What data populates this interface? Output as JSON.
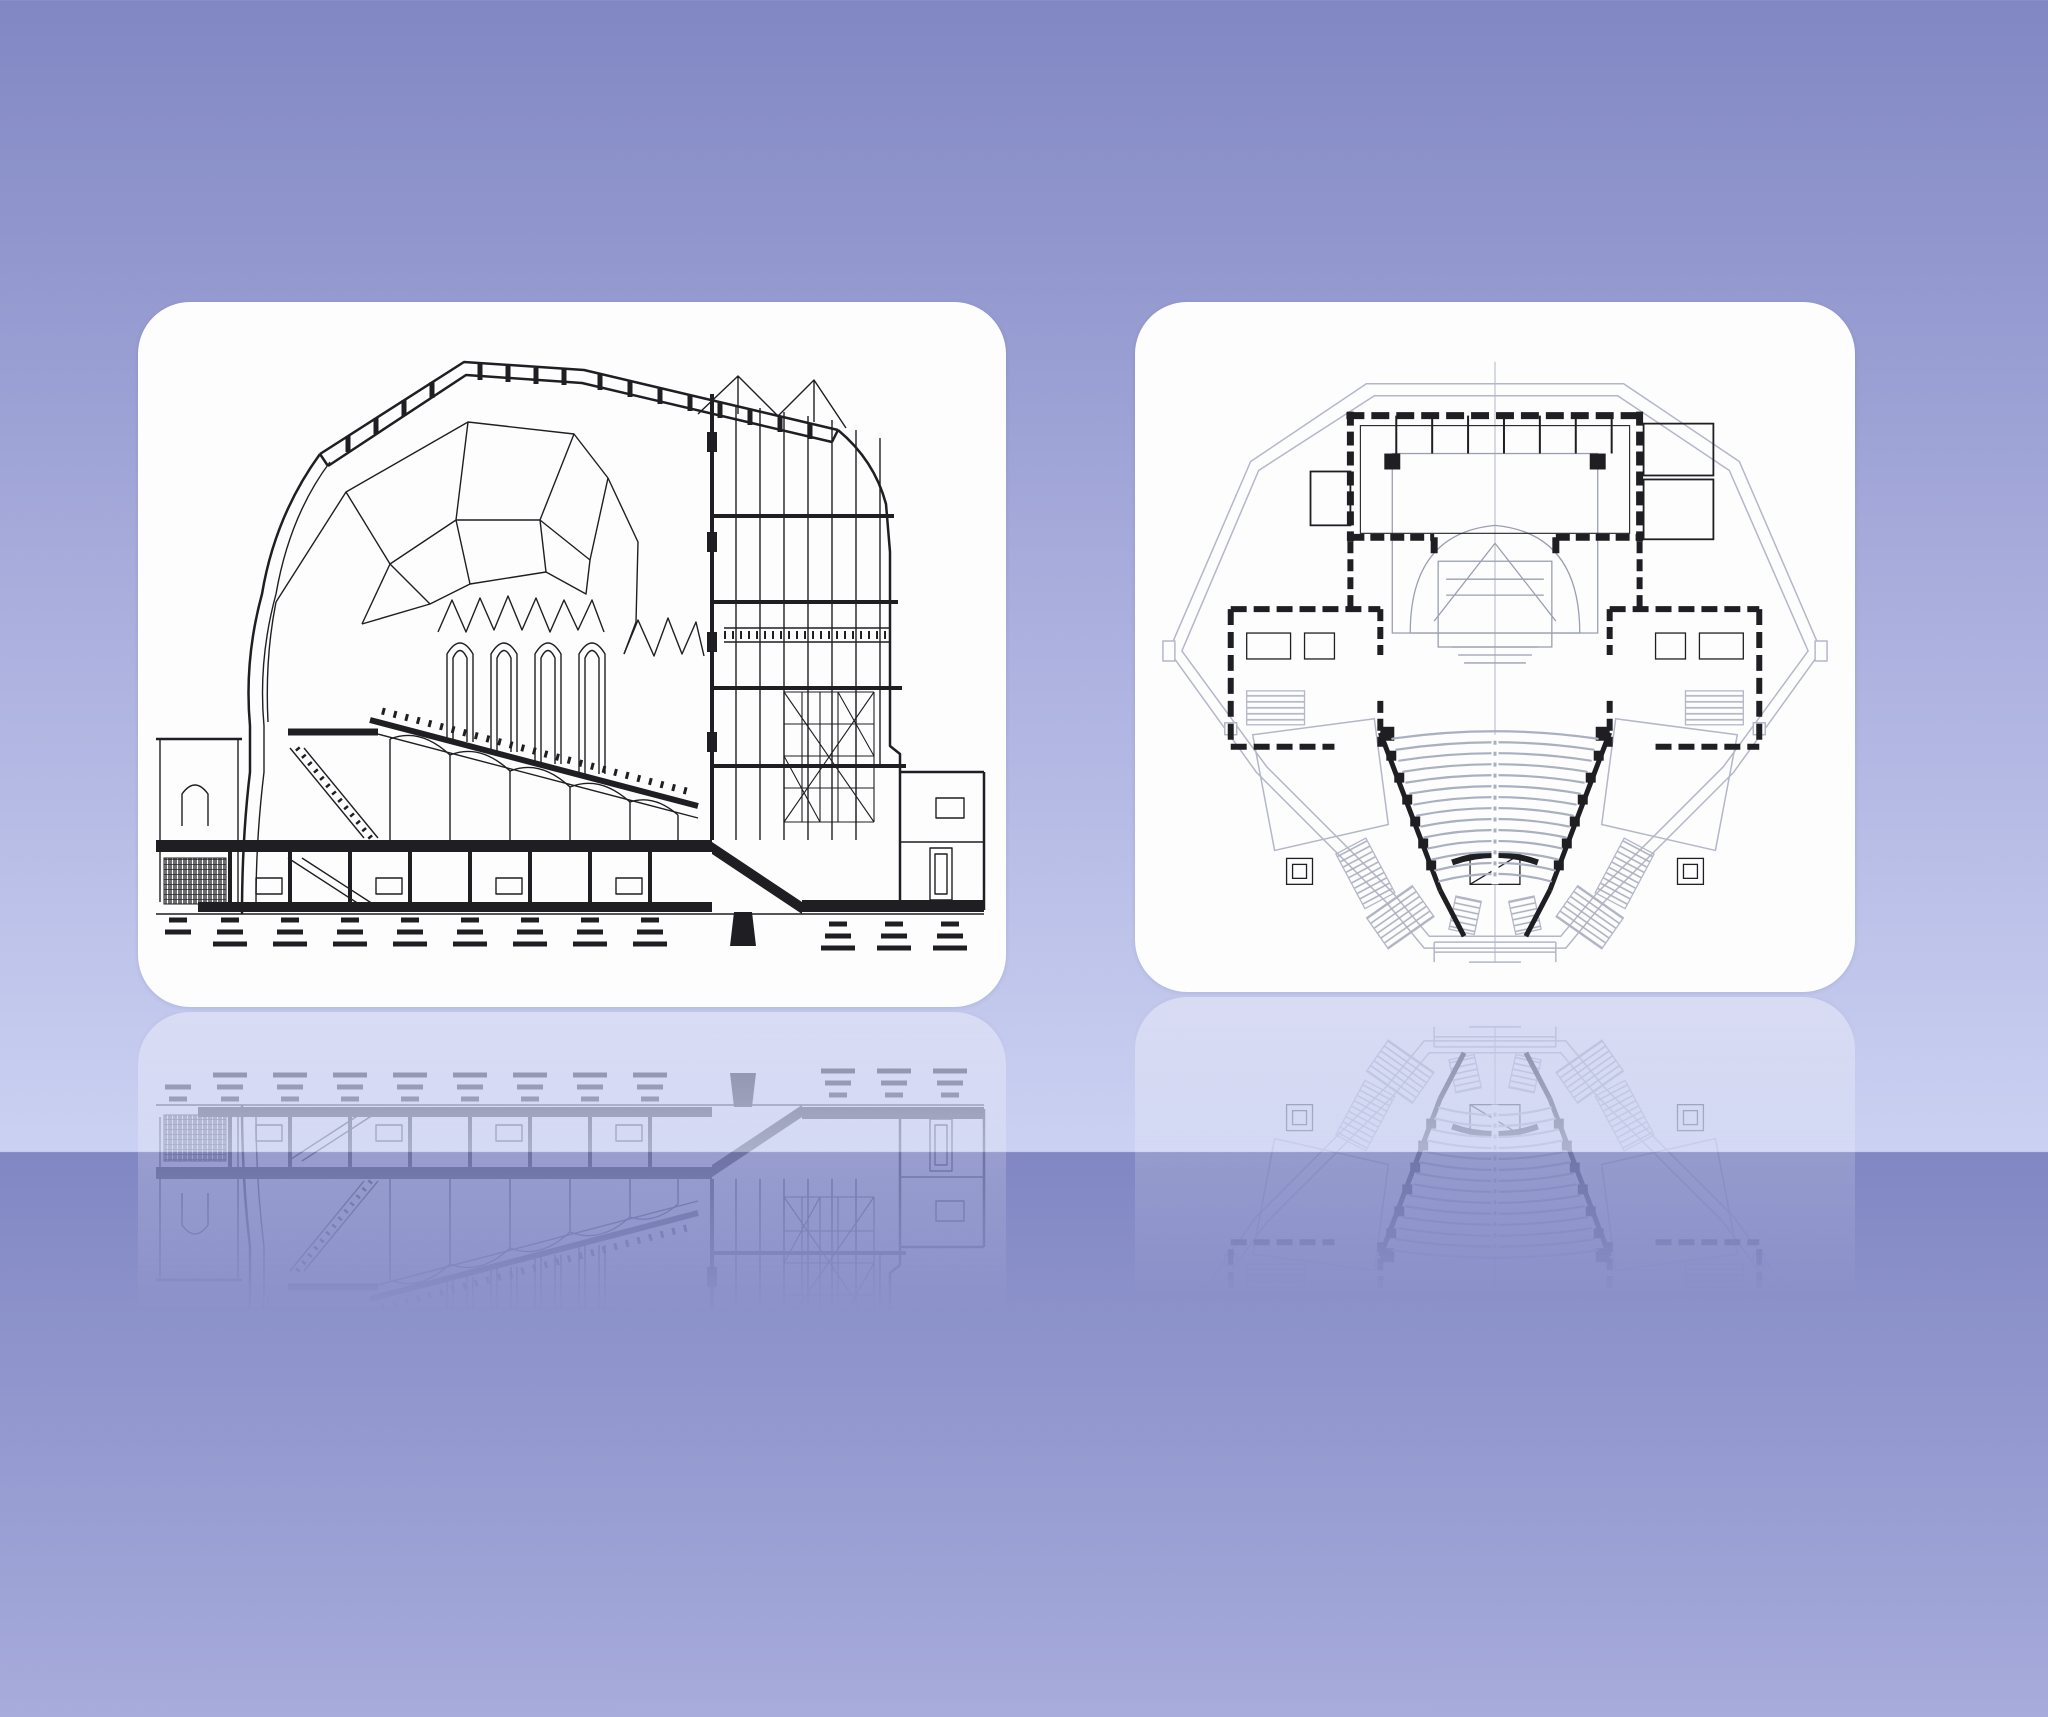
{
  "slide": {
    "background_top": "#8187c3",
    "background_mid": "#a9aedd",
    "background_bottom": "#cbd1f2",
    "card_background": "#fdfdfe",
    "ink": "#1f1f23",
    "plan_gray": "#b3b7c7",
    "seat_gray": "#aab0c0"
  },
  "figures": [
    {
      "id": "building-cross-section",
      "label": "Building cross-section drawing"
    },
    {
      "id": "auditorium-floor-plan",
      "label": "Auditorium floor plan drawing"
    }
  ]
}
